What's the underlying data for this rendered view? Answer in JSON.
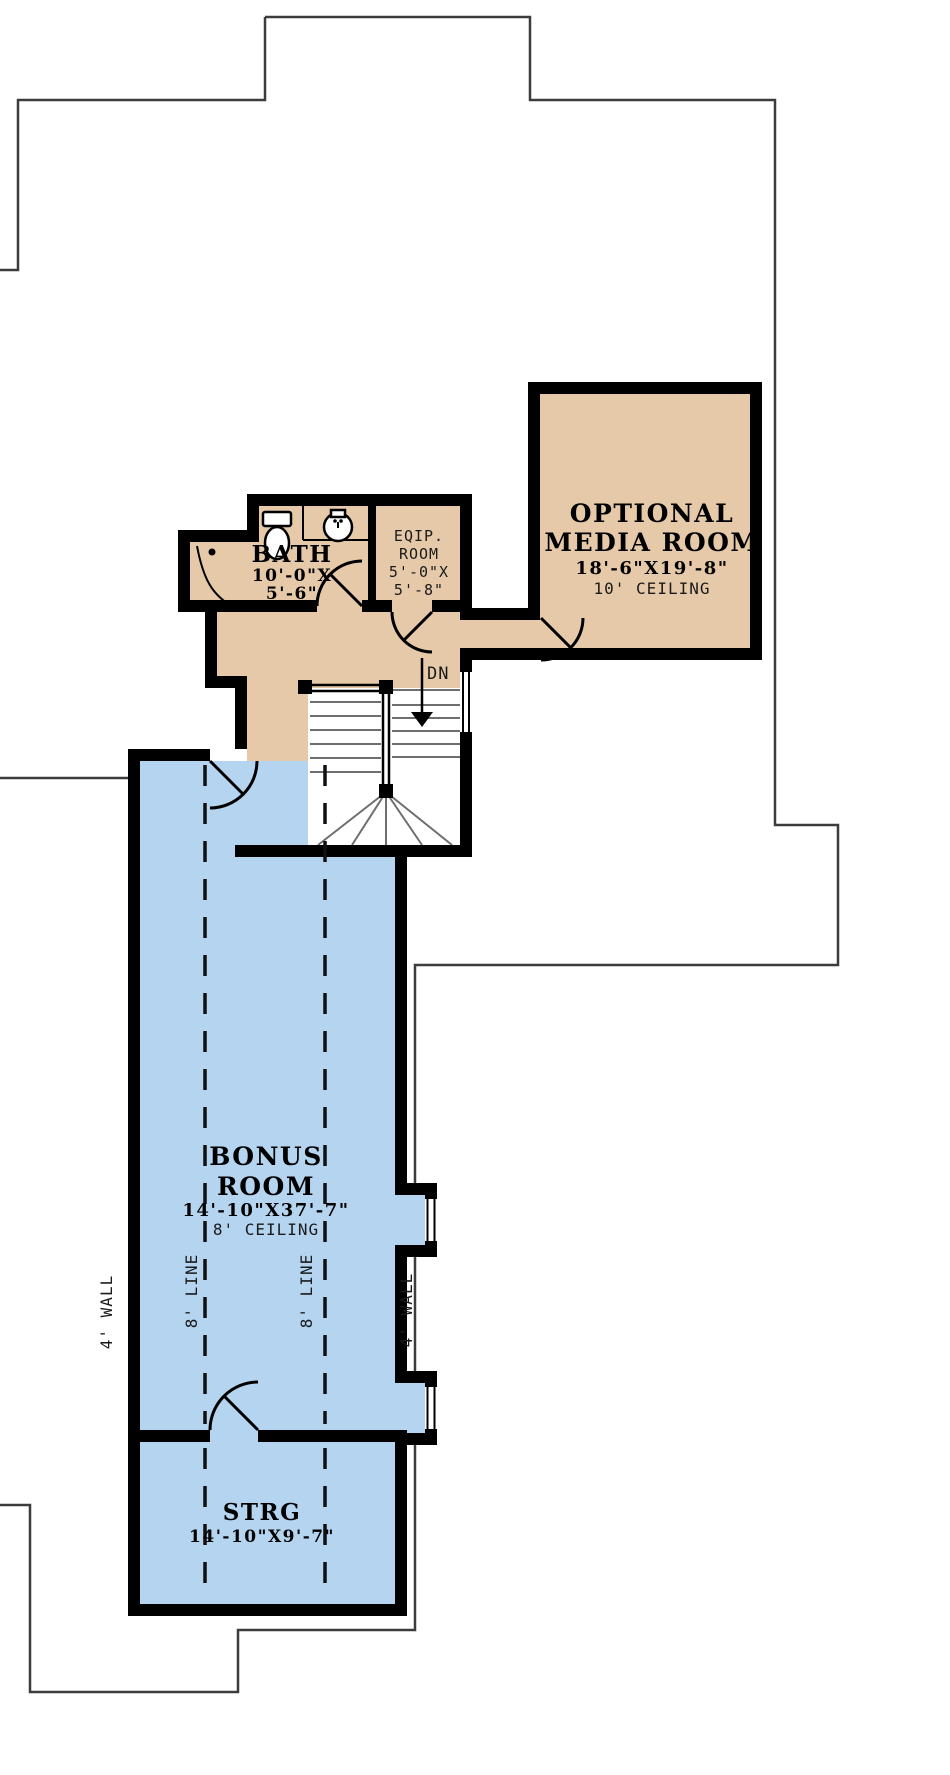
{
  "plan": {
    "rooms": {
      "media": {
        "line1": "OPTIONAL",
        "line2": "MEDIA ROOM",
        "dims": "18'-6\"X19'-8\"",
        "ceiling": "10' CEILING"
      },
      "bath": {
        "name": "BATH",
        "dims1": "10'-0\"X",
        "dims2": "5'-6\""
      },
      "equip": {
        "line1": "EQIP.",
        "line2": "ROOM",
        "dims1": "5'-0\"X",
        "dims2": "5'-8\""
      },
      "bonus": {
        "line1": "BONUS",
        "line2": "ROOM",
        "dims": "14'-10\"X37'-7\"",
        "ceiling": "8' CEILING"
      },
      "strg": {
        "name": "STRG",
        "dims": "14'-10\"X9'-7\""
      }
    },
    "annotations": {
      "dn": "DN",
      "wall_left": "4' WALL",
      "line_left": "8' LINE",
      "line_right": "8' LINE",
      "wall_right": "4' WALL"
    },
    "colors": {
      "tan": "#e5c9a9",
      "blue": "#b4d4f0",
      "wall": "#000000",
      "outline": "#3c3c3c"
    }
  }
}
